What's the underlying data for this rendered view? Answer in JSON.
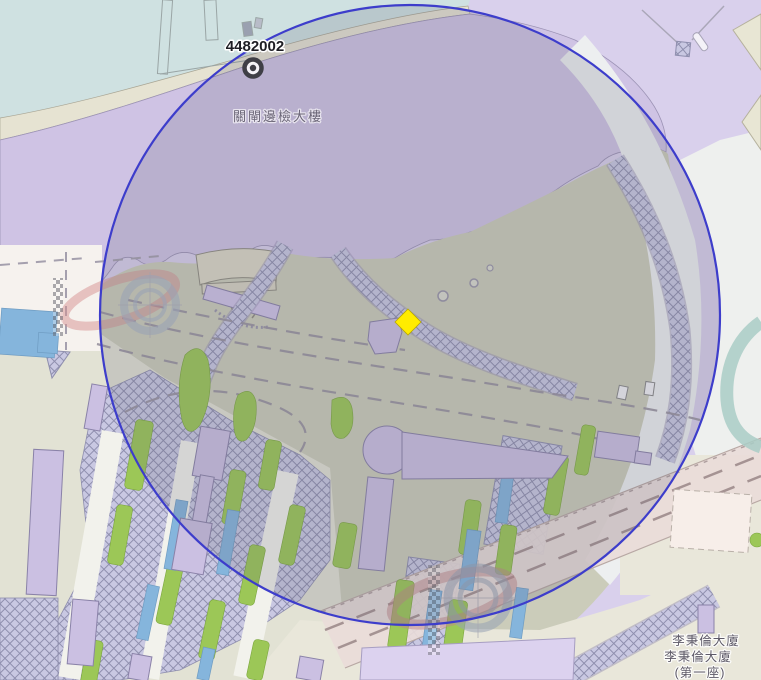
{
  "map": {
    "title": "map-canvas",
    "station_label": "4482002",
    "area_label": "關閘邊檢大樓",
    "se_labels": [
      "李秉倫大廈",
      "李秉倫大廈",
      "(第一座)"
    ],
    "icons": {
      "station_marker": "bullseye-icon",
      "selected_point": "yellow-diamond-icon",
      "watermark": "racetrack-checker-ring-icon"
    },
    "colors": {
      "circle_stroke": "#3d3dcb",
      "circle_tint": "rgba(100,98,118,0.20)",
      "selection_marker": "#ffec00",
      "water_teal": "#cfe1e1",
      "district_purple": "#cfc3e4",
      "plaza_olive": "#cbccba",
      "background_lavender": "#d9d0ec",
      "building_fill": "#cbc0e2",
      "building_stroke": "#8a82a8",
      "green_area": "#9cc757",
      "pool_blue": "#85b5dc",
      "shore_beige": "#e6e3d2",
      "rail_band": "#e9dcd9"
    }
  }
}
